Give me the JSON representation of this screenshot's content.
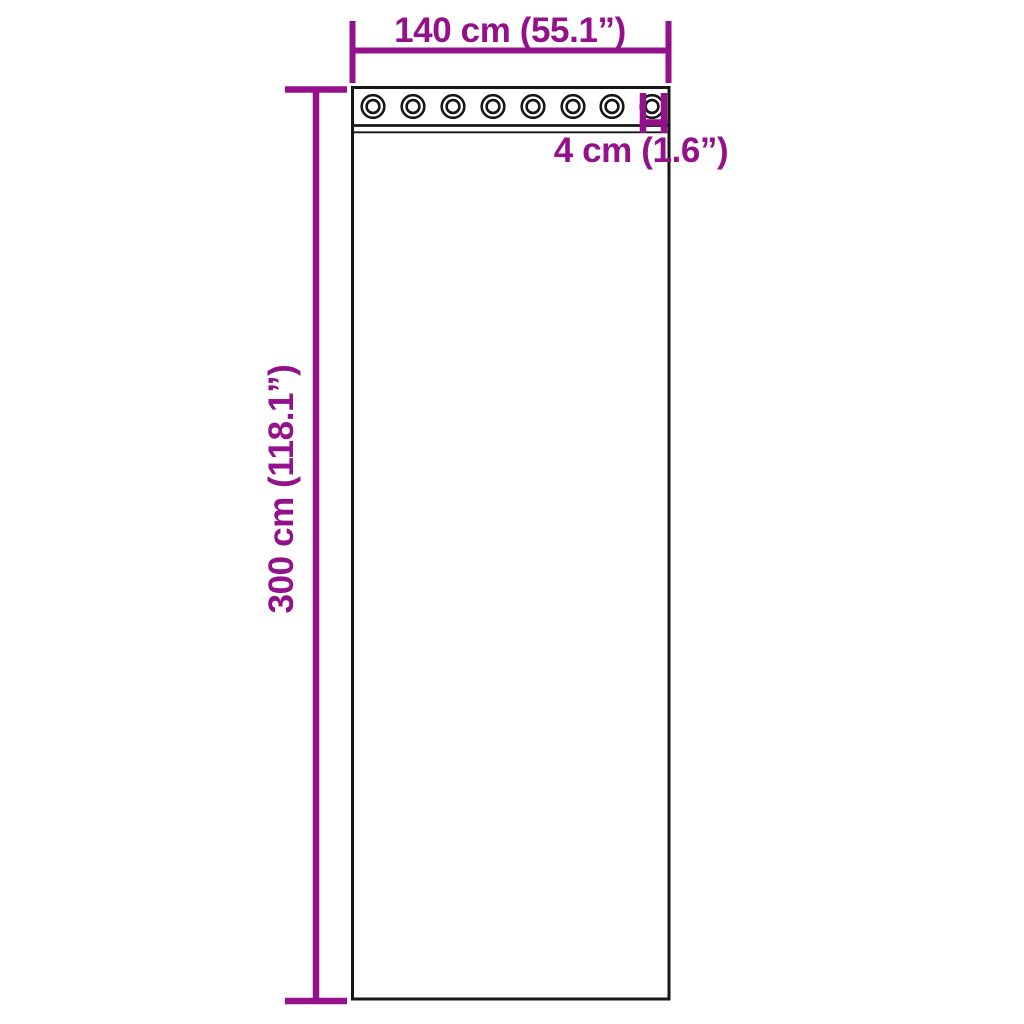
{
  "diagram": {
    "type": "product-dimension-diagram",
    "subject": "curtain panel with grommets",
    "background_color": "#ffffff",
    "accent_color": "#93118a",
    "outline_color": "#161616",
    "width_label": "140 cm (55.1”)",
    "height_label": "300 cm (118.1”)",
    "grommet_diameter_label": "4 cm (1.6”)",
    "grommet_count": 8
  }
}
